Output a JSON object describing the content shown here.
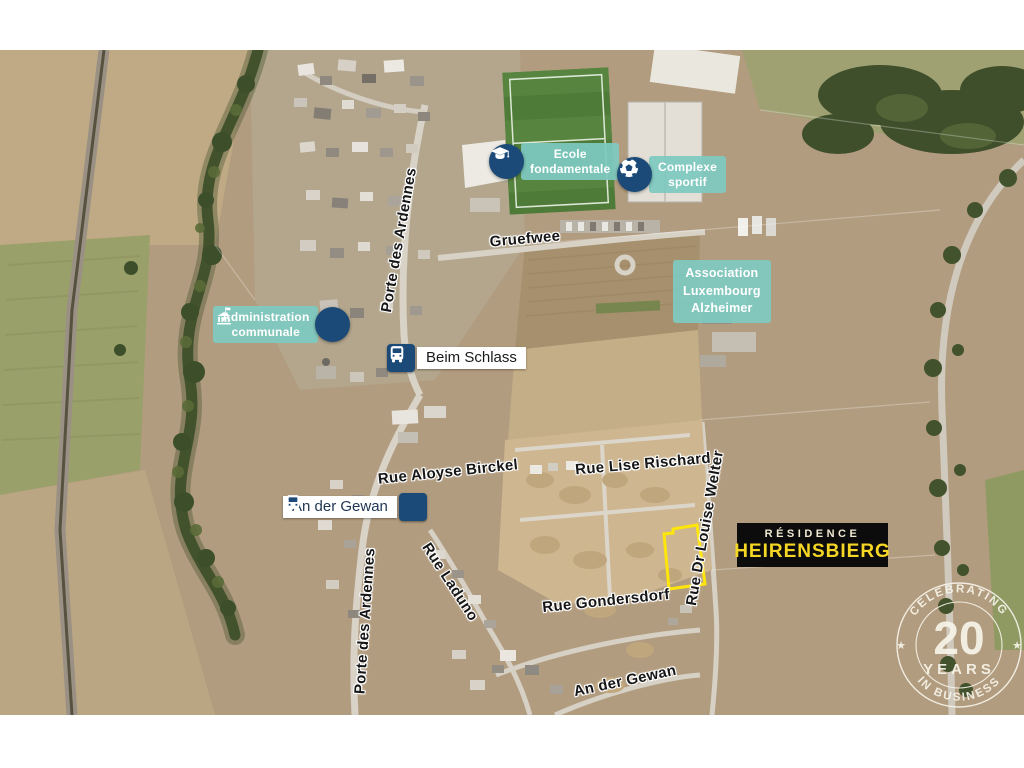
{
  "map": {
    "accent_teal": "#7ec9c1",
    "accent_navy": "#1b4a78",
    "accent_yellow": "#ffe60a",
    "pois": [
      {
        "id": "ecole",
        "icon": "graduation-cap-icon",
        "label": "Ecole\nfondamentale"
      },
      {
        "id": "complexe",
        "icon": "soccer-ball-icon",
        "label": "Complexe\nsportif"
      },
      {
        "id": "administration",
        "icon": "town-hall-icon",
        "label": "Administration\ncommunale"
      },
      {
        "id": "association",
        "icon": null,
        "label": "Association\nLuxembourg\nAlzheimer"
      }
    ],
    "bus_stops": [
      {
        "id": "beim-schlass",
        "icon": "bus-icon",
        "label": "Beim Schlass"
      },
      {
        "id": "an-der-gewan",
        "icon": "bus-icon",
        "label": "An der Gewan"
      }
    ],
    "streets": [
      {
        "id": "gruefwee",
        "label": "Gruefwee"
      },
      {
        "id": "porte-des-ardennes-top",
        "label": "Porte des Ardennes"
      },
      {
        "id": "rue-aloyse-birckel",
        "label": "Rue Aloyse Birckel"
      },
      {
        "id": "rue-lise-rischard",
        "label": "Rue Lise Rischard"
      },
      {
        "id": "rue-dr-louise-welter",
        "label": "Rue Dr Louise Welter"
      },
      {
        "id": "rue-laduno",
        "label": "Rue Laduno"
      },
      {
        "id": "porte-des-ardennes-bottom",
        "label": "Porte des Ardennes"
      },
      {
        "id": "rue-gondersdorf",
        "label": "Rue Gondersdorf"
      },
      {
        "id": "an-der-gewan-street",
        "label": "An der Gewan"
      }
    ],
    "residence": {
      "line1": "RÉSIDENCE",
      "line2": "HEIRENSBIERG",
      "accent": "#f5d625"
    },
    "badge": {
      "top": "CELEBRATING",
      "number": "20",
      "mid": "YEARS",
      "bottom": "IN BUSINESS"
    }
  }
}
